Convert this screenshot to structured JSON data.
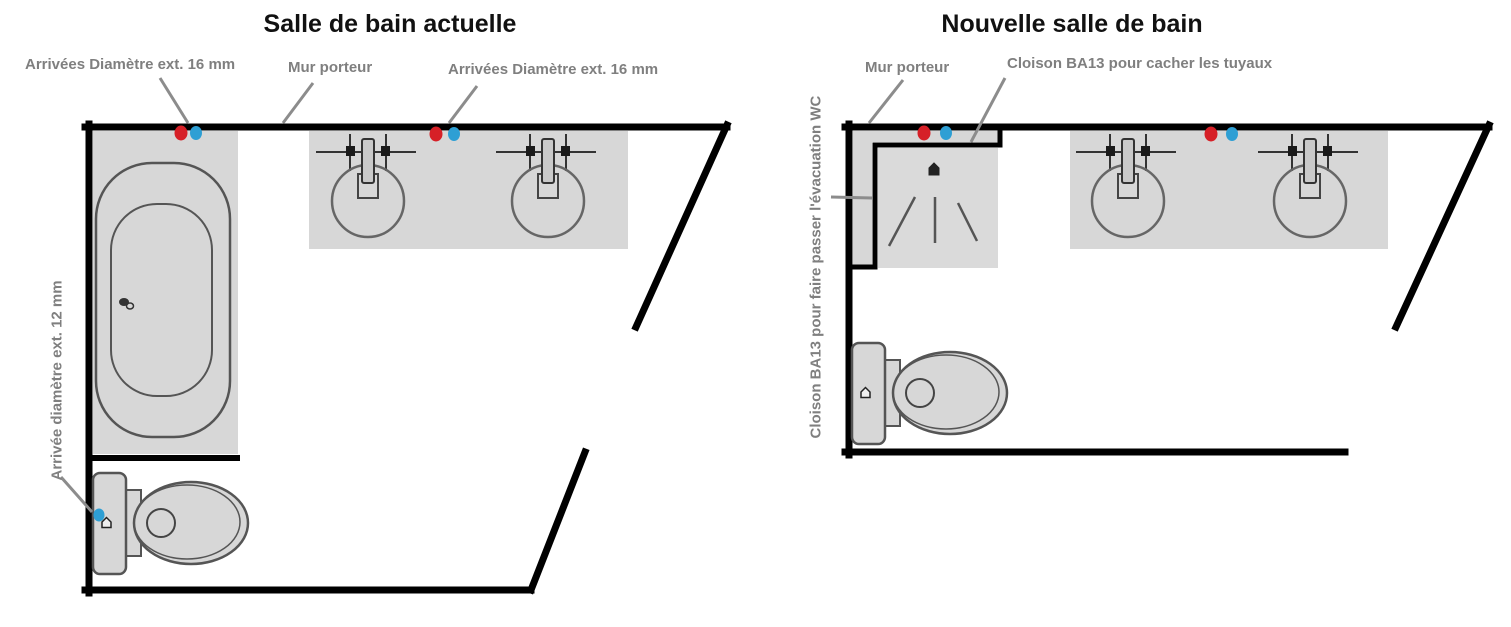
{
  "colors": {
    "hot_water": "#d62027",
    "cold_water": "#2e9fd4",
    "wall": "#000000",
    "fixture_fill": "#d7d7d7",
    "fixture_outline": "#555555",
    "label_gray": "#7f7f7f"
  },
  "left_plan": {
    "title": "Salle de  bain actuelle",
    "labels": {
      "supply_16_left": "Arrivées Diamètre ext. 16 mm",
      "load_bearing_wall": "Mur porteur",
      "supply_16_right": "Arrivées Diamètre ext. 16 mm",
      "supply_12_vertical": "Arrivée diamètre ext. 12 mm"
    }
  },
  "right_plan": {
    "title": "Nouvelle salle de bain",
    "labels": {
      "load_bearing_wall": "Mur porteur",
      "partition_hide_pipes": "Cloison BA13 pour cacher les tuyaux",
      "partition_wc_vertical": "Cloison BA13 pour faire passer l'évacuation WC"
    }
  }
}
